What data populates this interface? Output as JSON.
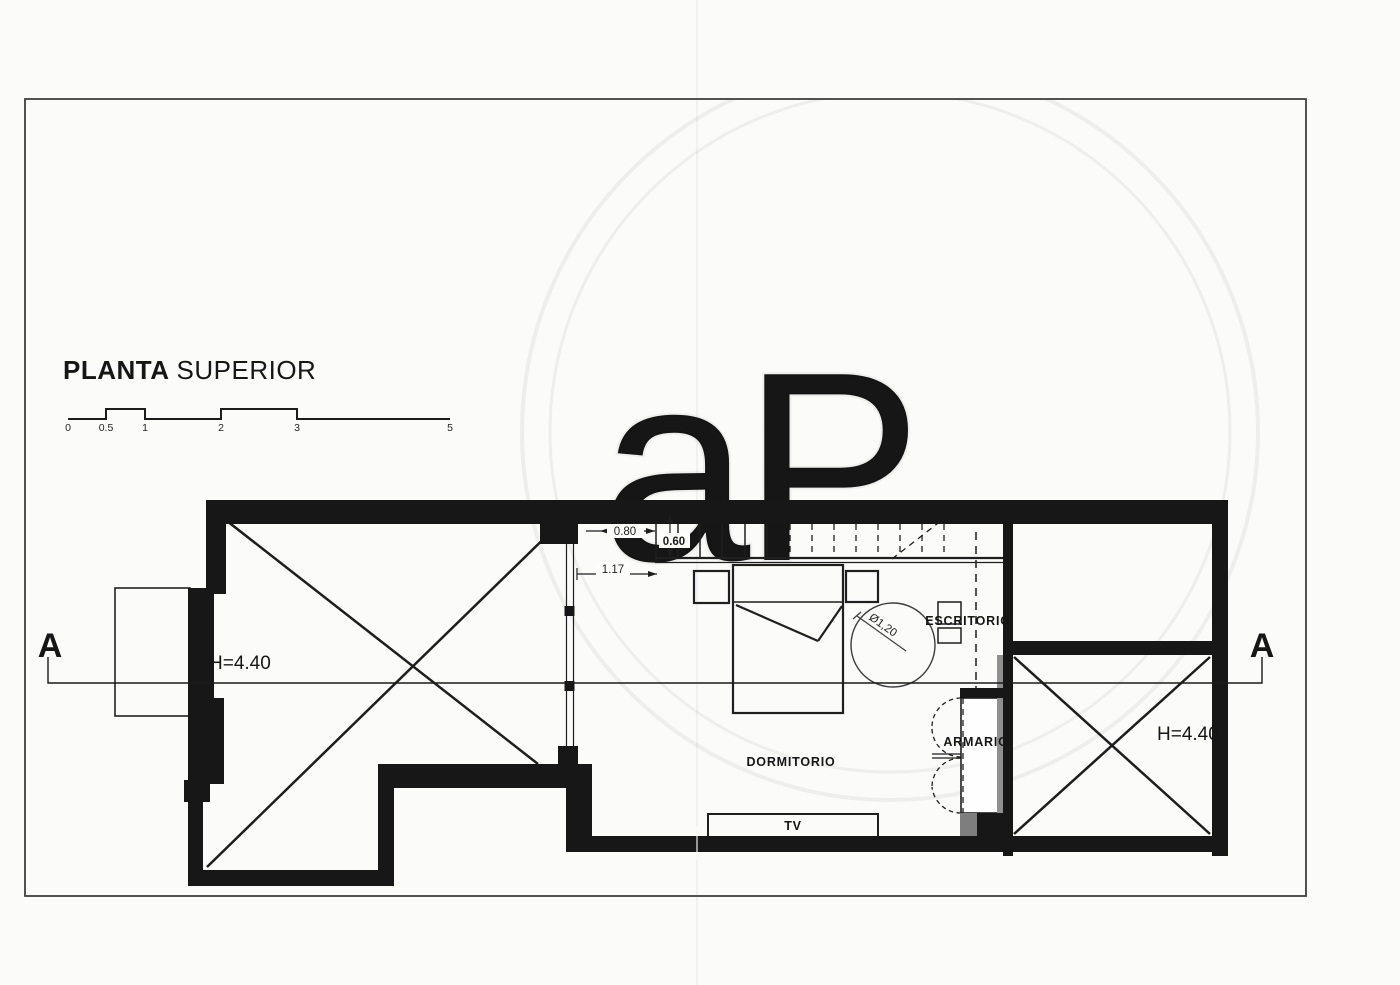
{
  "document": {
    "title_bold": "PLANTA",
    "title_regular": "SUPERIOR",
    "watermark": "aP"
  },
  "scale_bar": {
    "labels": [
      "0",
      "0.5",
      "1",
      "2",
      "3",
      "5"
    ]
  },
  "section_markers": {
    "left": "A",
    "right": "A"
  },
  "room_labels": {
    "dormitorio": "DORMITORIO",
    "escritorio": "ESCRITORIO",
    "armario": "ARMARIO",
    "tv": "TV"
  },
  "height_labels": {
    "left": "H=4.40",
    "right": "H=4.40"
  },
  "dimension_labels": {
    "opening": "0.80",
    "stair_width": "0.60",
    "landing": "1.17",
    "circle_diameter": "Ø1,20"
  },
  "colors": {
    "paper": "#fbfbfa",
    "wall": "#171717",
    "line": "#1e1e1e",
    "gray_fill": "#8f8f8f",
    "watermark": "#ededed"
  }
}
